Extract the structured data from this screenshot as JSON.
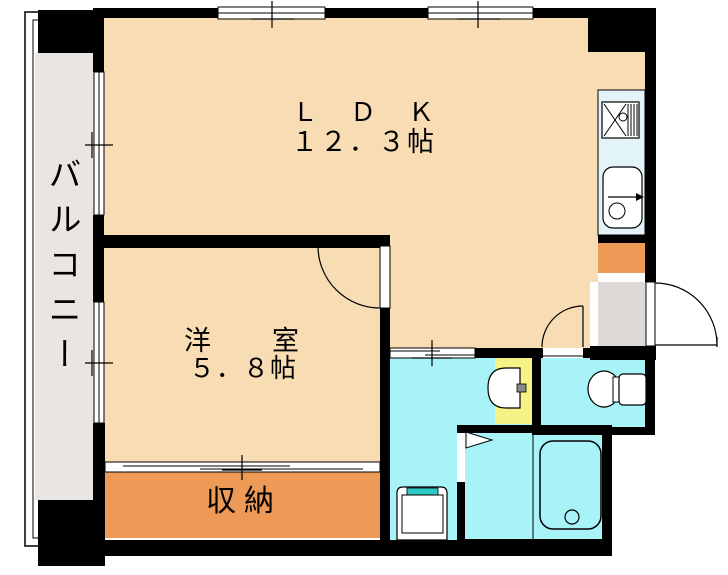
{
  "plan": {
    "rooms": {
      "balcony": {
        "label": "バルコニー"
      },
      "ldk": {
        "name": "ＬＤＫ",
        "size": "１２．３帖"
      },
      "western": {
        "name": "洋　室",
        "size": "５．８帖"
      },
      "storage": {
        "label": "収納"
      }
    },
    "fixtures": {
      "kitchen_stove": "gas-stove-icon",
      "kitchen_sink": "kitchen-sink-icon",
      "wash_basin": "washbasin-icon",
      "washing_machine": "washing-machine-icon",
      "bathtub": "bathtub-icon",
      "toilet": "toilet-icon"
    }
  },
  "colors": {
    "wall": "#000000",
    "room_floor": "#f8dcb4",
    "balcony_floor": "#e9e5e3",
    "entry_floor": "#dedad8",
    "storage_fill": "#ec9a55",
    "wet_area": "#a8f3f8",
    "kitchen_counter": "#e2f4f8",
    "washbasin_counter": "#f6f287",
    "washer_accent": "#2cc8c4",
    "opening": "#ffffff"
  }
}
